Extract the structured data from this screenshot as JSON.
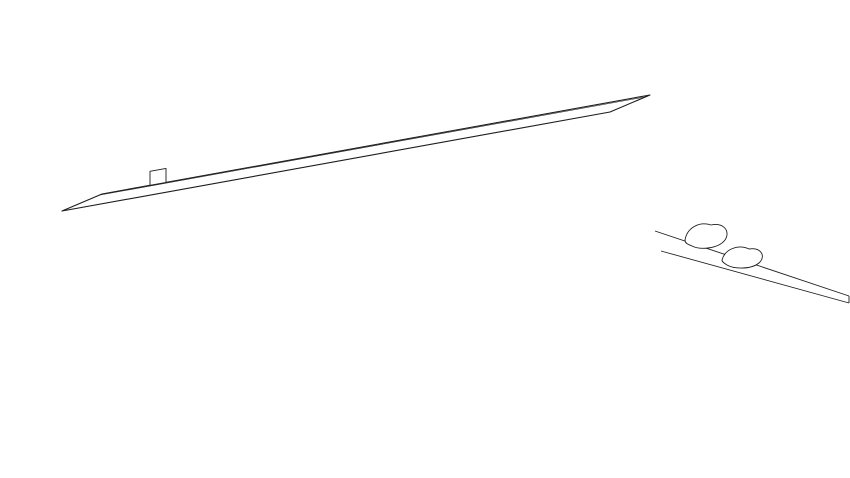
{
  "diagram": {
    "type": "axonometric-building-unit-diagram",
    "background": "#ffffff",
    "line_color": "#1d1d1d",
    "label_color": "#3b3b3b",
    "status_colors": {
      "green": "#a9d5ae",
      "yellow": "#f6e964"
    }
  },
  "building": {
    "floors": 7,
    "sections": 6,
    "units": [
      {
        "id": "701",
        "col": 1,
        "floor": 7,
        "highlight": "none"
      },
      {
        "id": "702",
        "col": 2,
        "floor": 7,
        "highlight": "none"
      },
      {
        "id": "703",
        "col": 3,
        "floor": 7,
        "highlight": "none"
      },
      {
        "id": "704",
        "col": 4,
        "floor": 7,
        "highlight": "green"
      },
      {
        "id": "705",
        "col": 5,
        "floor": 7,
        "highlight": "green"
      },
      {
        "id": "706",
        "col": 6,
        "floor": 7,
        "highlight": "none"
      },
      {
        "id": "601",
        "col": 1,
        "floor": 6,
        "highlight": "green"
      },
      {
        "id": "602",
        "col": 2,
        "floor": 6,
        "highlight": "none"
      },
      {
        "id": "603",
        "col": 3,
        "floor": 6,
        "highlight": "green"
      },
      {
        "id": "604",
        "col": 4,
        "floor": 6,
        "highlight": "none"
      },
      {
        "id": "605",
        "col": 5,
        "floor": 6,
        "highlight": "none"
      },
      {
        "id": "606",
        "col": 6,
        "floor": 6,
        "highlight": "green"
      },
      {
        "id": "501",
        "col": 1,
        "floor": 5,
        "highlight": "none"
      },
      {
        "id": "502",
        "col": 2,
        "floor": 5,
        "highlight": "yellow"
      },
      {
        "id": "503",
        "col": 3,
        "floor": 5,
        "highlight": "none"
      },
      {
        "id": "504",
        "col": 4,
        "floor": 5,
        "highlight": "none"
      },
      {
        "id": "505",
        "col": 5,
        "floor": 5,
        "highlight": "green"
      },
      {
        "id": "506",
        "col": 6,
        "floor": 5,
        "highlight": "none"
      },
      {
        "id": "401",
        "col": 1,
        "floor": 4,
        "highlight": "none"
      },
      {
        "id": "402",
        "col": 2,
        "floor": 4,
        "highlight": "none"
      },
      {
        "id": "403",
        "col": 3,
        "floor": 4,
        "highlight": "none"
      },
      {
        "id": "404",
        "col": 4,
        "floor": 4,
        "highlight": "yellow"
      },
      {
        "id": "405",
        "col": 5,
        "floor": 4,
        "highlight": "none"
      },
      {
        "id": "406",
        "col": 6,
        "floor": 4,
        "highlight": "none"
      },
      {
        "id": "301",
        "col": 1,
        "floor": 3,
        "highlight": "none"
      },
      {
        "id": "302",
        "col": 2,
        "floor": 3,
        "highlight": "green"
      },
      {
        "id": "303",
        "col": 3,
        "floor": 3,
        "highlight": "none"
      },
      {
        "id": "304",
        "col": 4,
        "floor": 3,
        "highlight": "none"
      },
      {
        "id": "305",
        "col": 5,
        "floor": 3,
        "highlight": "none"
      },
      {
        "id": "306",
        "col": 6,
        "floor": 3,
        "highlight": "green"
      },
      {
        "id": "201",
        "col": 1,
        "floor": 2,
        "highlight": "none"
      },
      {
        "id": "202",
        "col": 2,
        "floor": 2,
        "highlight": "none"
      },
      {
        "id": "203",
        "col": 3,
        "floor": 2,
        "highlight": "green"
      },
      {
        "id": "204",
        "col": 4,
        "floor": 2,
        "highlight": "none"
      },
      {
        "id": "205",
        "col": 5,
        "floor": 2,
        "highlight": "green"
      }
    ],
    "ground_units": [
      {
        "id": "101",
        "x": 100,
        "ly": 383
      },
      {
        "id": "102",
        "x": 265,
        "ly": 382
      },
      {
        "id": "103",
        "x": 315,
        "ly": 381
      },
      {
        "id": "104",
        "x": 340,
        "ly": 379
      },
      {
        "id": "105",
        "x": 372,
        "ly": 378
      },
      {
        "id": "106",
        "x": 403,
        "ly": 377
      },
      {
        "id": "107",
        "x": 428,
        "ly": 373
      },
      {
        "id": "108",
        "x": 455,
        "ly": 370
      },
      {
        "id": "109",
        "x": 477,
        "ly": 367
      },
      {
        "id": "110",
        "x": 502,
        "ly": 363.5
      }
    ]
  }
}
